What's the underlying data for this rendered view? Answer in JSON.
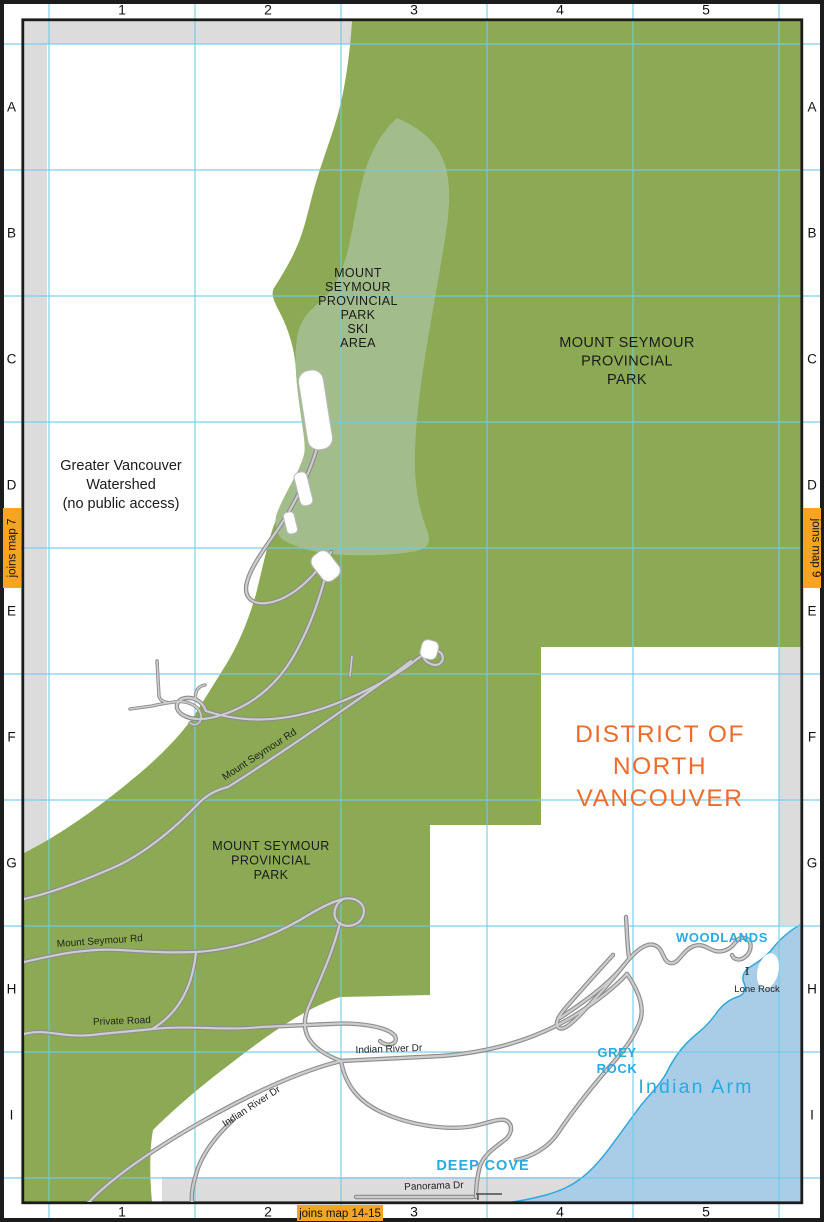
{
  "grid": {
    "cols": [
      "1",
      "2",
      "3",
      "4",
      "5"
    ],
    "rows": [
      "A",
      "B",
      "C",
      "D",
      "E",
      "F",
      "G",
      "H",
      "I"
    ]
  },
  "tabs": {
    "left": "joins map 7",
    "right": "joins map 9",
    "bottom": "joins map 14-15"
  },
  "labels": {
    "ski_area": [
      "MOUNT",
      "SEYMOUR",
      "PROVINCIAL",
      "PARK",
      "SKI",
      "AREA"
    ],
    "park_east": [
      "MOUNT SEYMOUR",
      "PROVINCIAL",
      "PARK"
    ],
    "park_south": [
      "MOUNT SEYMOUR",
      "PROVINCIAL",
      "PARK"
    ],
    "watershed": [
      "Greater Vancouver",
      "Watershed",
      "(no public access)"
    ],
    "district": [
      "DISTRICT OF",
      "NORTH",
      "VANCOUVER"
    ],
    "woodlands": "WOODLANDS",
    "grey_rock": [
      "GREY",
      "ROCK"
    ],
    "indian_arm": "Indian Arm",
    "deep_cove": "DEEP COVE",
    "lone_rock": "Lone Rock",
    "lone_rock_marker": "I"
  },
  "roads": {
    "mount_seymour_rd_upper": "Mount Seymour Rd",
    "mount_seymour_rd_lower": "Mount Seymour Rd",
    "private_road": "Private Road",
    "indian_river_dr_east": "Indian River Dr",
    "indian_river_dr_west": "Indian River Dr",
    "panorama_dr": "Panorama Dr"
  },
  "colors": {
    "park": "#8CAA53",
    "ski_area": "#A3BC8B",
    "water": "#A9CCE7",
    "coast": "#2FA9DC",
    "grid_line": "#6FCBE9",
    "tab": "#F6A421",
    "district_text": "#ED6C2B",
    "water_text": "#29ABE2",
    "margin_strip": "#DCDCDC",
    "road_casing": "#8C8C8C",
    "road_fill": "#CDCDCD",
    "frame": "#1C1C1C"
  }
}
